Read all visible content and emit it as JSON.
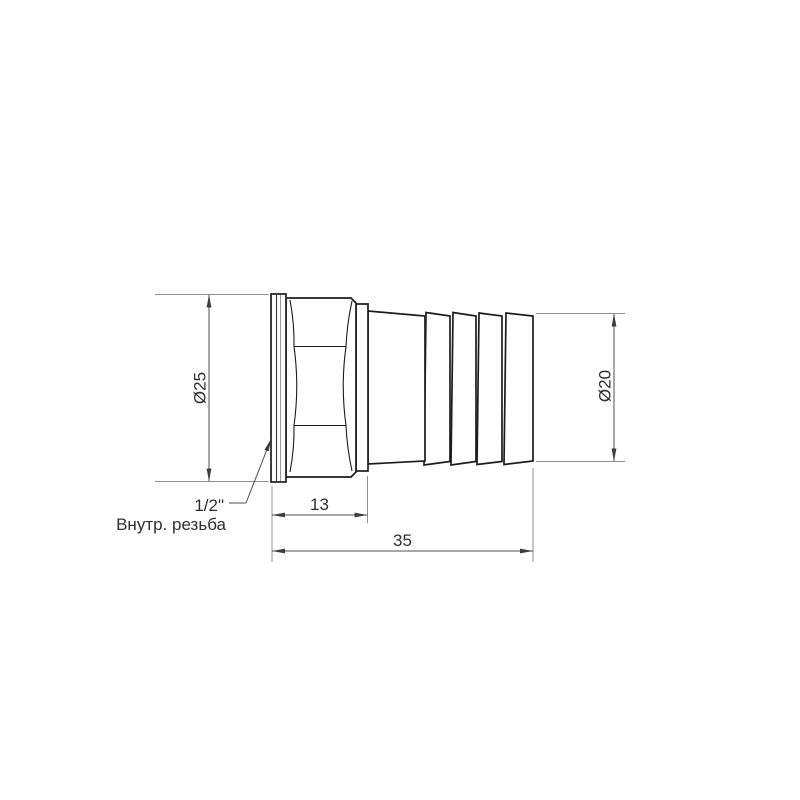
{
  "colors": {
    "background": "#ffffff",
    "part_outline": "#1c1c1c",
    "dimension_lines": "#4d4d4d",
    "extension_lines": "#8f8f8f",
    "text": "#2e2e2e"
  },
  "labels": {
    "outer_diameter": "Ø25",
    "barb_diameter": "Ø20",
    "body_length": "13",
    "total_length": "35",
    "thread_size": "1/2\"",
    "thread_note": "Внутр. резьба"
  }
}
